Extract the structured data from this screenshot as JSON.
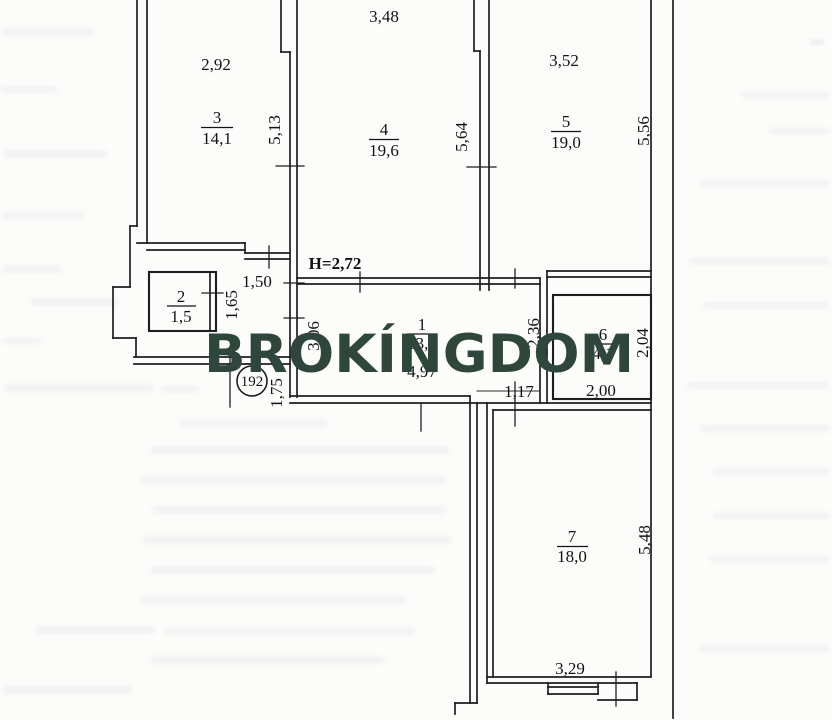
{
  "plan": {
    "apartment_number": "192",
    "ceiling_height": "H=2,72",
    "rooms": {
      "r1": {
        "number": "1",
        "area": "13,1"
      },
      "r2": {
        "number": "2",
        "area": "1,5"
      },
      "r3": {
        "number": "3",
        "area": "14,1"
      },
      "r4": {
        "number": "4",
        "area": "19,6"
      },
      "r5": {
        "number": "5",
        "area": "19,0"
      },
      "r6": {
        "number": "6",
        "area": "4,1"
      },
      "r7": {
        "number": "7",
        "area": "18,0"
      }
    },
    "dims": {
      "room3_width": "2,92",
      "room4_width": "3,48",
      "room5_width": "3,52",
      "room3_depth": "5,13",
      "room4_depth": "5,64",
      "room5_depth": "5,56",
      "hall_opening": "1,50",
      "closet_depth": "1,65",
      "corridor_length": "4,97",
      "corridor_depth": "3,06",
      "vestibule_depth": "2,36",
      "entry_width": "1,75",
      "passage_width": "1,17",
      "room6_width": "2,00",
      "room6_depth": "2,04",
      "room7_width": "3,29",
      "room7_depth": "5,48"
    }
  },
  "watermark": {
    "text": "BROKÍNGDOM",
    "color": "#2e463c"
  }
}
